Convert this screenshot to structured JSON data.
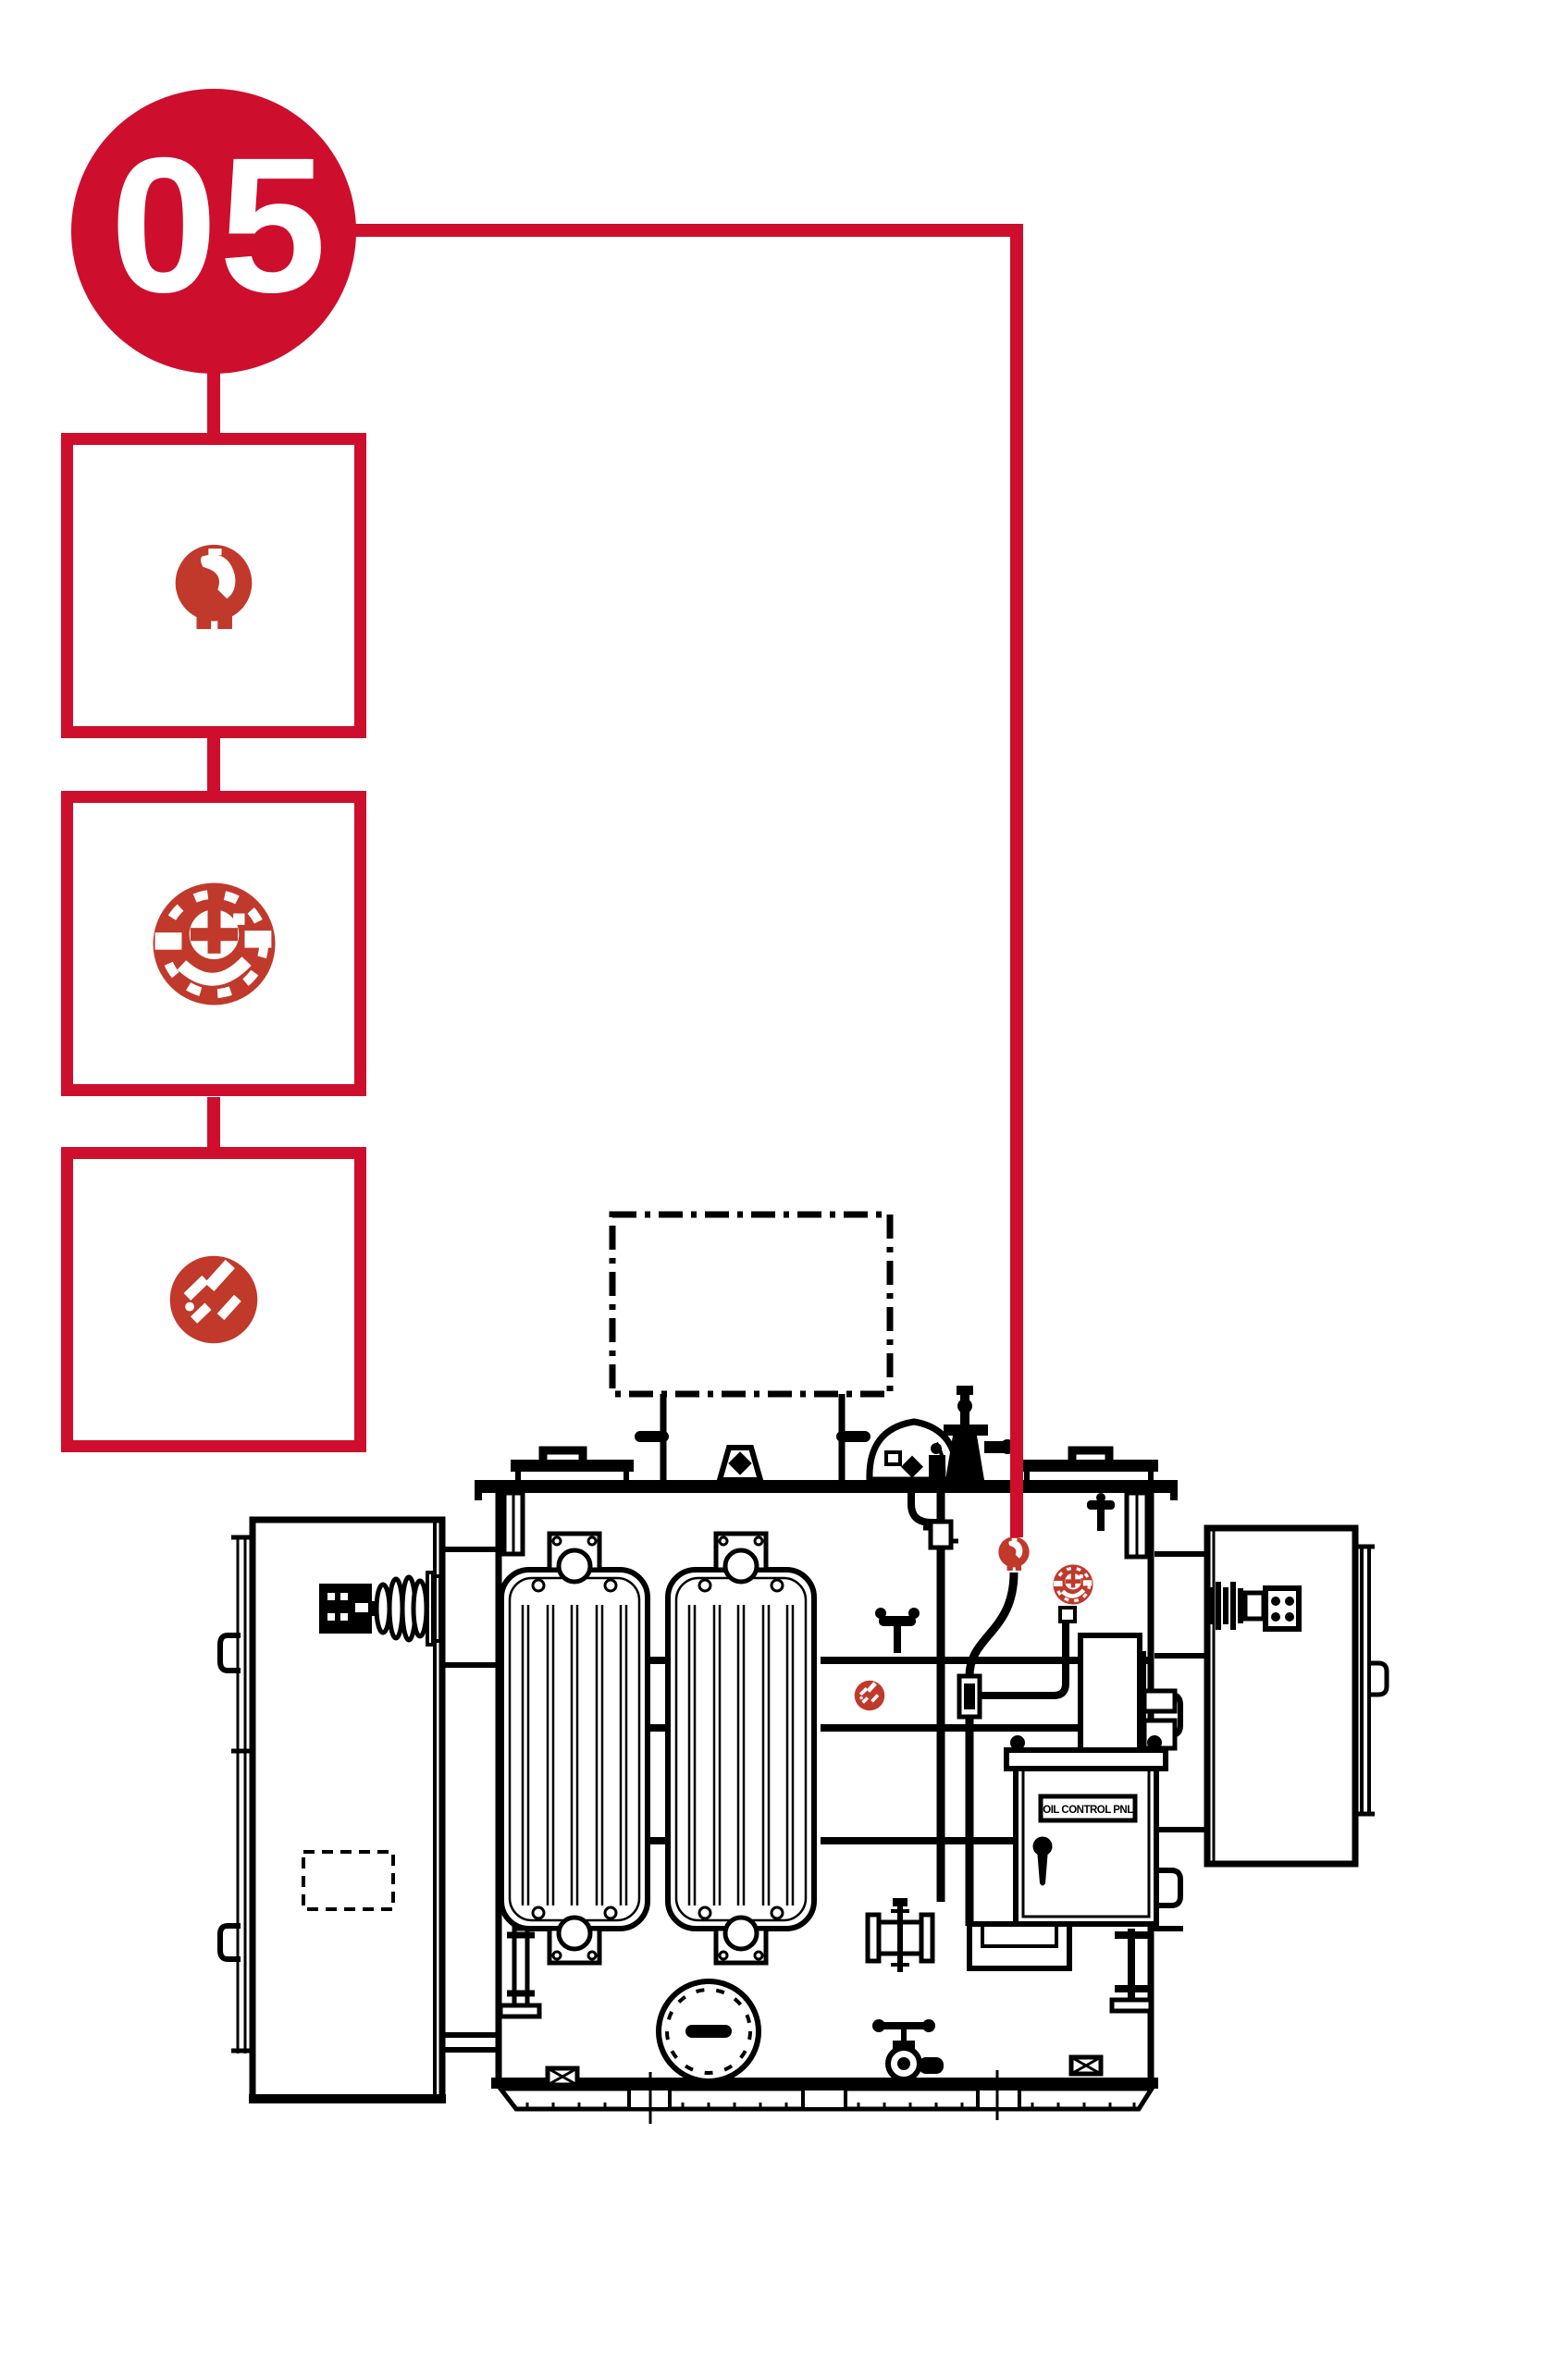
{
  "page": {
    "width_px": "1695",
    "height_px": "2560",
    "background": "#ffffff"
  },
  "colors": {
    "brand_red": "#ce0e2d",
    "icon_red": "#c0392b",
    "drawing_black": "#000000",
    "white": "#ffffff"
  },
  "badge": {
    "number": "05"
  },
  "callout": {
    "detail_boxes": [
      {
        "icon": "breather-relief-valve-icon"
      },
      {
        "icon": "oil-dial-gauge-icon"
      },
      {
        "icon": "drain-valve-icon"
      }
    ]
  },
  "diagram": {
    "cabinet_label": "OIL CONTROL PNL"
  }
}
